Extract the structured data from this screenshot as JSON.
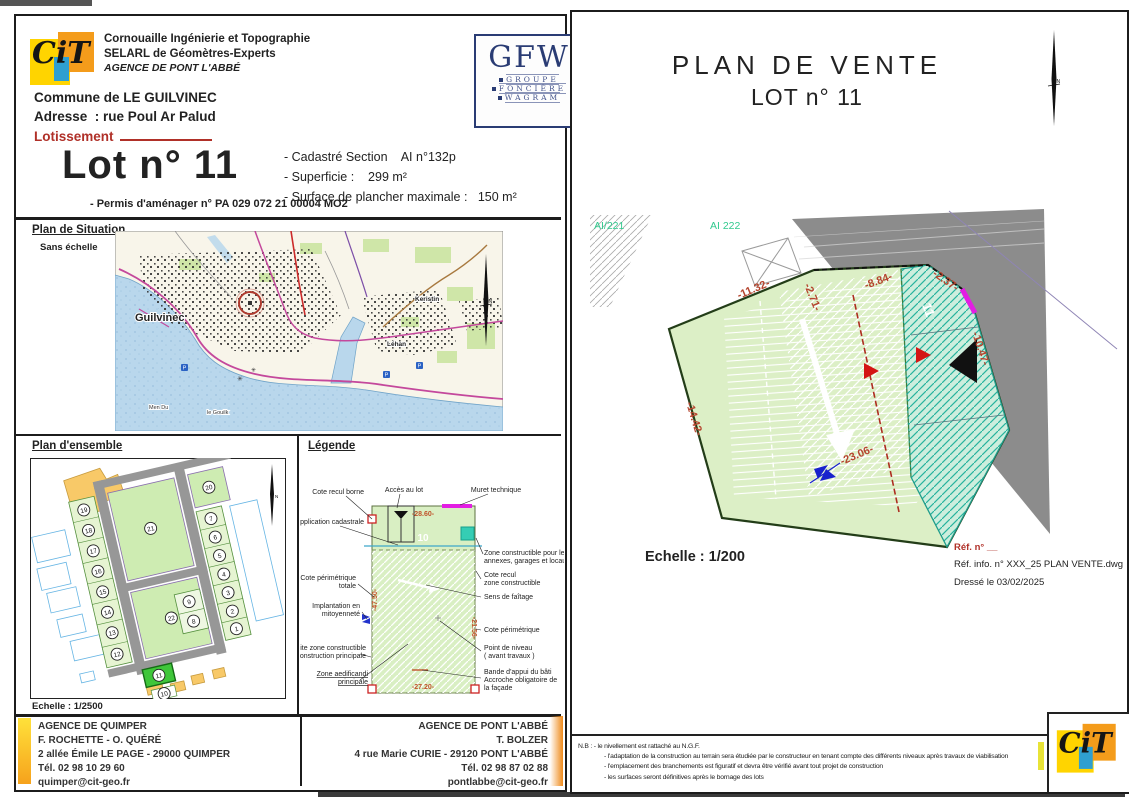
{
  "misc": {
    "north": "N"
  },
  "header": {
    "company_line1": "Cornouaille Ingénierie et Topographie",
    "company_line2": "SELARL de Géomètres-Experts",
    "company_line3": "AGENCE DE PONT L'ABBÉ",
    "gfw": "GFW",
    "gfw_w1": "GROUPE",
    "gfw_w2": "FONCIÈRE",
    "gfw_w3": "WAGRAM",
    "cit_script": "CiT"
  },
  "info": {
    "commune": "Commune de LE GUILVINEC",
    "adresse": "Adresse  : rue Poul Ar Palud",
    "lotissement_label": "Lotissement",
    "lot_title": "Lot n° 11",
    "cadastre": "- Cadastré Section    AI n°132p",
    "superficie": "- Superficie :    299 m²",
    "plancher": "- Surface de plancher maximale :   150 m²",
    "permis": "- Permis d'aménager n° PA 029 072 21 00004 MO2"
  },
  "situation": {
    "title": "Plan de Situation",
    "subtitle": "Sans échelle",
    "town": "Guilvinec",
    "lehan": "Léhan",
    "keristin": "Keristin",
    "men_du": "Men Du",
    "gouilk": "le Gouilk"
  },
  "ensemble": {
    "title": "Plan d'ensemble",
    "echelle": "Echelle : 1/2500",
    "lots_left": [
      "19",
      "18",
      "17",
      "16",
      "15",
      "14",
      "13",
      "12"
    ],
    "lots_right": [
      "7",
      "6",
      "5",
      "4",
      "3",
      "2",
      "1"
    ],
    "lots_mid": [
      "9",
      "8"
    ],
    "lot11": "11",
    "lot10": "10",
    "zone_top": "21",
    "zone_bottom": "22",
    "zone_corner": "20"
  },
  "legende": {
    "title": "Légende",
    "lot": "10",
    "dim_top": "-28.60-",
    "dim_left": "-47.50-",
    "dim_right": "-21.56-",
    "dim_bottom": "-27.20-",
    "cote_recul_borne": "Cote recul borne",
    "acces": "Accès au lot",
    "muret": "Muret technique",
    "application": "Application cadastrale",
    "zone_constructible_1": "Zone constructible pour les",
    "zone_constructible_2": "annexes, garages et locaux",
    "cote_peri_totale_1": "Cote périmétrique",
    "cote_peri_totale_2": "totale",
    "cote_recul_zone_1": "Cote recul",
    "cote_recul_zone_2": "zone constructible",
    "sens_faitage": "Sens de faîtage",
    "implantation_1": "Implantation en",
    "implantation_2": "mitoyenneté",
    "cote_perimetrique": "Cote périmétrique",
    "limite_1": "Limite zone constructible",
    "limite_2": "de la construction principale",
    "point_niveau_1": "Point de niveau",
    "point_niveau_2": "( avant travaux )",
    "zone_aedificandi_1": "Zone aedificandi",
    "zone_aedificandi_2": "principale",
    "bande_1": "Bande d'appui du bâti",
    "bande_2": "Accroche obligatoire de",
    "bande_3": "la façade"
  },
  "footer": {
    "quimper_l1": "AGENCE DE QUIMPER",
    "quimper_l2": "F. ROCHETTE - O. QUÉRÉ",
    "quimper_l3": "2 allée Émile LE PAGE - 29000 QUIMPER",
    "quimper_l4": "Tél. 02 98 10 29 60",
    "quimper_l5": "quimper@cit-geo.fr",
    "pontlabbe_l1": "AGENCE DE PONT L'ABBÉ",
    "pontlabbe_l2": "T. BOLZER",
    "pontlabbe_l3": "4 rue Marie CURIE - 29120 PONT L'ABBÉ",
    "pontlabbe_l4": "Tél. 02 98 87 02 88",
    "pontlabbe_l5": "pontlabbe@cit-geo.fr"
  },
  "plan": {
    "title1": "PLAN DE VENTE",
    "title2": "LOT n° 11",
    "ai221": "AI/221",
    "ai222": "AI 222",
    "lot_number": "11",
    "d1": "-11.32-",
    "d2": "-2.71-",
    "d3": "-8.84-",
    "d4": "-2.37-",
    "d5": "-10.47-",
    "d6": "-14.42-",
    "d7": "-23.06-",
    "echelle": "Echelle : 1/200",
    "ref1": "Réf. n° __",
    "ref2": "Réf. info. n° XXX_25 PLAN VENTE.dwg",
    "ref3": "Dressé le 03/02/2025",
    "nb1": "N.B :  - le nivellement est rattaché au N.G.F.",
    "nb2": "- l'adaptation de la construction au terrain sera étudiée par le constructeur en tenant compte des différents niveaux après travaux de viabilisation",
    "nb3": "- l'emplacement des branchements est figuratif et devra être vérifié avant tout projet de construction",
    "nb4": "- les surfaces seront définitives après le bornage des lots"
  }
}
